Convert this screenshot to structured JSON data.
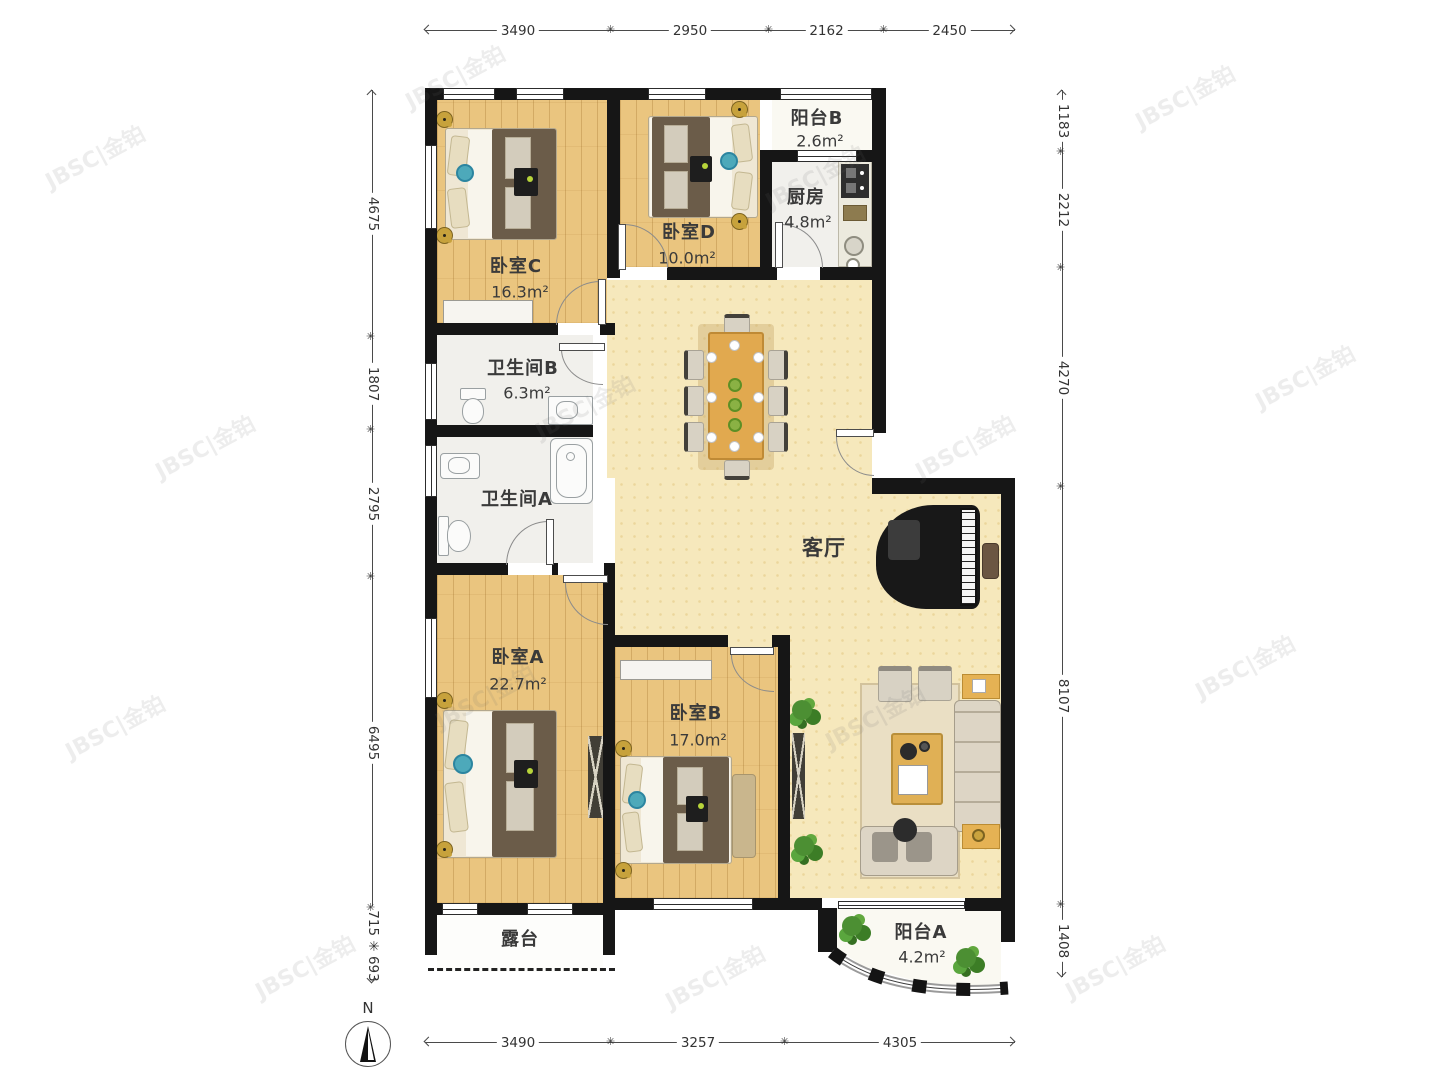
{
  "plan": {
    "rooms": {
      "bedroomC": {
        "name": "卧室C",
        "area": "16.3m²"
      },
      "bedroomD": {
        "name": "卧室D",
        "area": "10.0m²"
      },
      "balconyB": {
        "name": "阳台B",
        "area": "2.6m²"
      },
      "kitchen": {
        "name": "厨房",
        "area": "4.8m²"
      },
      "bathroomB": {
        "name": "卫生间B",
        "area": "6.3m²"
      },
      "bathroomA": {
        "name": "卫生间A"
      },
      "living": {
        "name": "客厅"
      },
      "bedroomA": {
        "name": "卧室A",
        "area": "22.7m²"
      },
      "bedroomB": {
        "name": "卧室B",
        "area": "17.0m²"
      },
      "terrace": {
        "name": "露台"
      },
      "balconyA": {
        "name": "阳台A",
        "area": "4.2m²"
      }
    },
    "dimensions": {
      "top": [
        "3490",
        "2950",
        "2162",
        "2450"
      ],
      "bottom": [
        "3490",
        "3257",
        "4305"
      ],
      "left": [
        "4675",
        "1807",
        "2795",
        "6495",
        "715 ✳ 693"
      ],
      "right": [
        "1183",
        "2212",
        "4270",
        "8107",
        "1408"
      ]
    },
    "compass": {
      "label": "N"
    },
    "watermark": {
      "text": "JBSC|金铂"
    }
  }
}
